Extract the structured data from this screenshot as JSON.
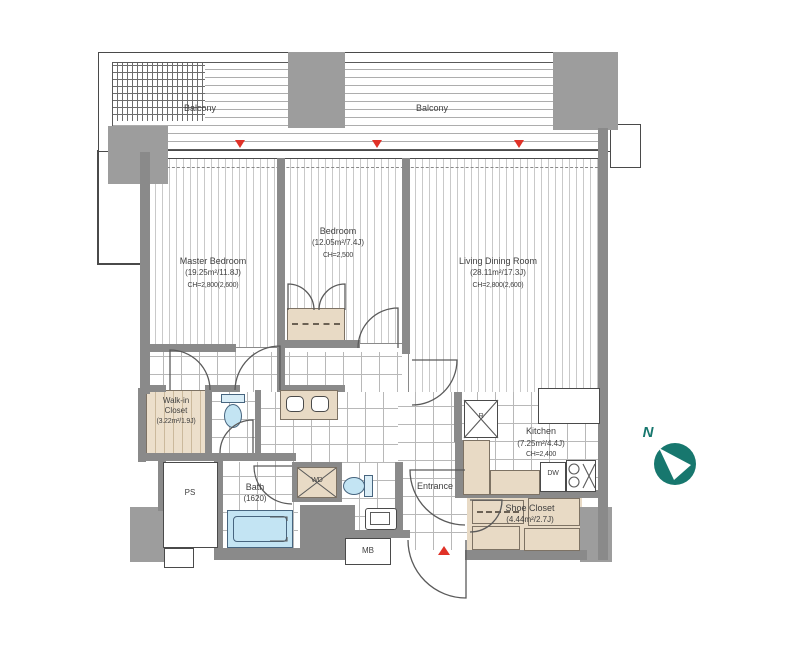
{
  "compass": {
    "label": "N",
    "color": "#17776e"
  },
  "rooms": {
    "balcony_left": {
      "name": "Balcony"
    },
    "balcony_right": {
      "name": "Balcony"
    },
    "master_bedroom": {
      "name": "Master Bedroom",
      "area": "(19.25m²/11.8J)",
      "ceiling": "CH=2,800(2,600)"
    },
    "bedroom": {
      "name": "Bedroom",
      "area": "(12.05m²/7.4J)",
      "ceiling": "CH=2,500"
    },
    "living_dining_room": {
      "name": "Living Dining Room",
      "area": "(28.11m²/17.3J)",
      "ceiling": "CH=2,800(2,600)"
    },
    "walk_in_closet": {
      "name_line1": "Walk-in",
      "name_line2": "Closet",
      "area": "(3.22m²/1.9J)"
    },
    "kitchen": {
      "name": "Kitchen",
      "area": "(7.25m²/4.4J)",
      "ceiling": "CH=2,400"
    },
    "bath": {
      "name": "Bath",
      "size": "(1620)"
    },
    "entrance": {
      "name": "Entrance"
    },
    "shoe_closet": {
      "name": "Shoe Closet",
      "area": "(4.44m²/2.7J)"
    }
  },
  "labels": {
    "ps": "PS",
    "mb": "MB",
    "wd": "WD",
    "dw": "DW",
    "refrigerator": "R"
  },
  "markers": {
    "red_color": "#e03127",
    "wall_color": "#8a8a8a",
    "water_color": "#c3e4f3",
    "cabinet_color": "#e8dac5"
  }
}
